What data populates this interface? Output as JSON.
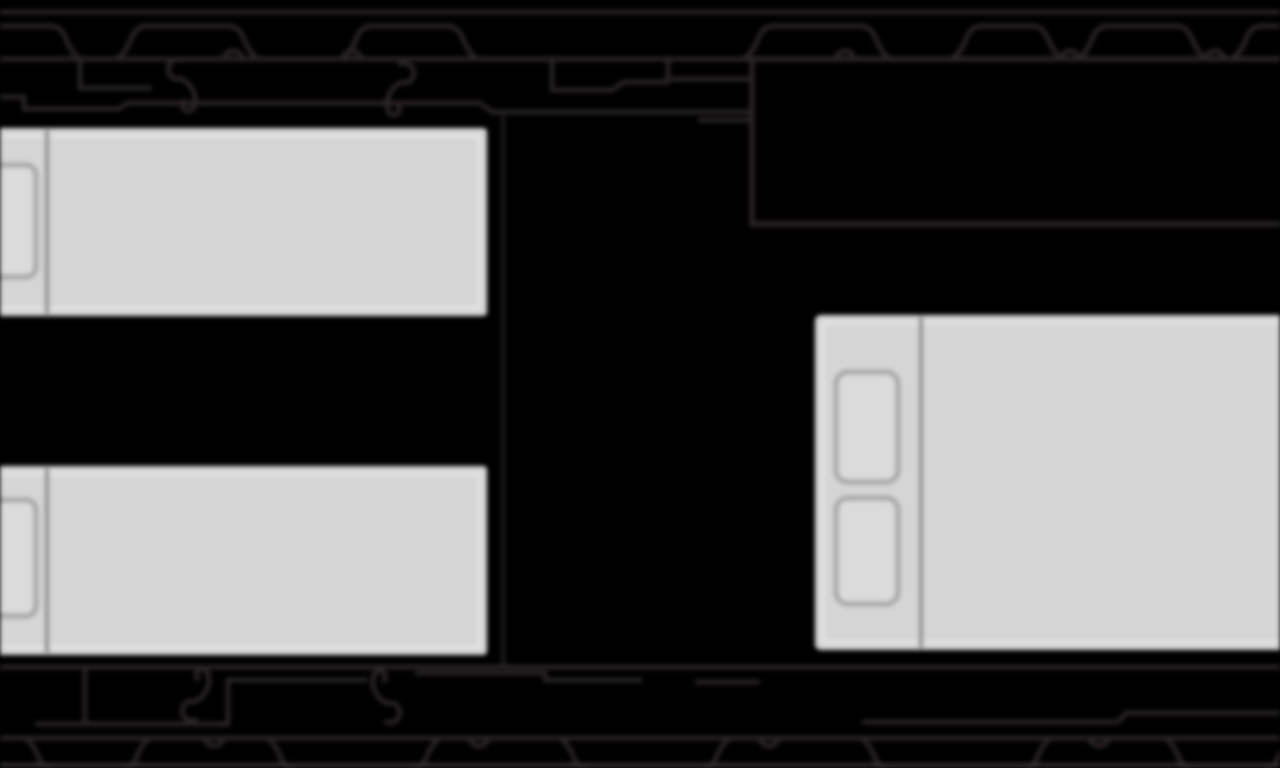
{
  "scene": {
    "description": "Extreme close-up fragment of a monochrome deck/floor plan: two single-bed cabins at left, a double bed at lower right, a dark room outline at upper right, and lifeboat/davit deck-edge linework bands along the top and bottom.",
    "background": "#000000",
    "linework": "#2b2526",
    "edge_line": "#3a3536",
    "faint_wall": "#1e1b1c",
    "room_fill": "#000000",
    "bed_fill": "#d5d5d5",
    "bed_highlight": "#e9e9e9",
    "bed_divider": "#8f8f8f",
    "pillow_stroke": "#a6a6a6",
    "pillow_fill": "#dbdbdb"
  },
  "elements": {
    "beds": [
      {
        "id": "bed-upper-left",
        "type": "single",
        "pillows": 1
      },
      {
        "id": "bed-lower-left",
        "type": "single",
        "pillows": 1
      },
      {
        "id": "bed-lower-right",
        "type": "double",
        "pillows": 2
      }
    ],
    "dark_room": {
      "id": "room-upper-right"
    },
    "bands": [
      {
        "id": "deck-edge-top"
      },
      {
        "id": "deck-edge-bottom"
      }
    ],
    "davit_hooks": {
      "top": 2,
      "bottom": 2
    }
  }
}
